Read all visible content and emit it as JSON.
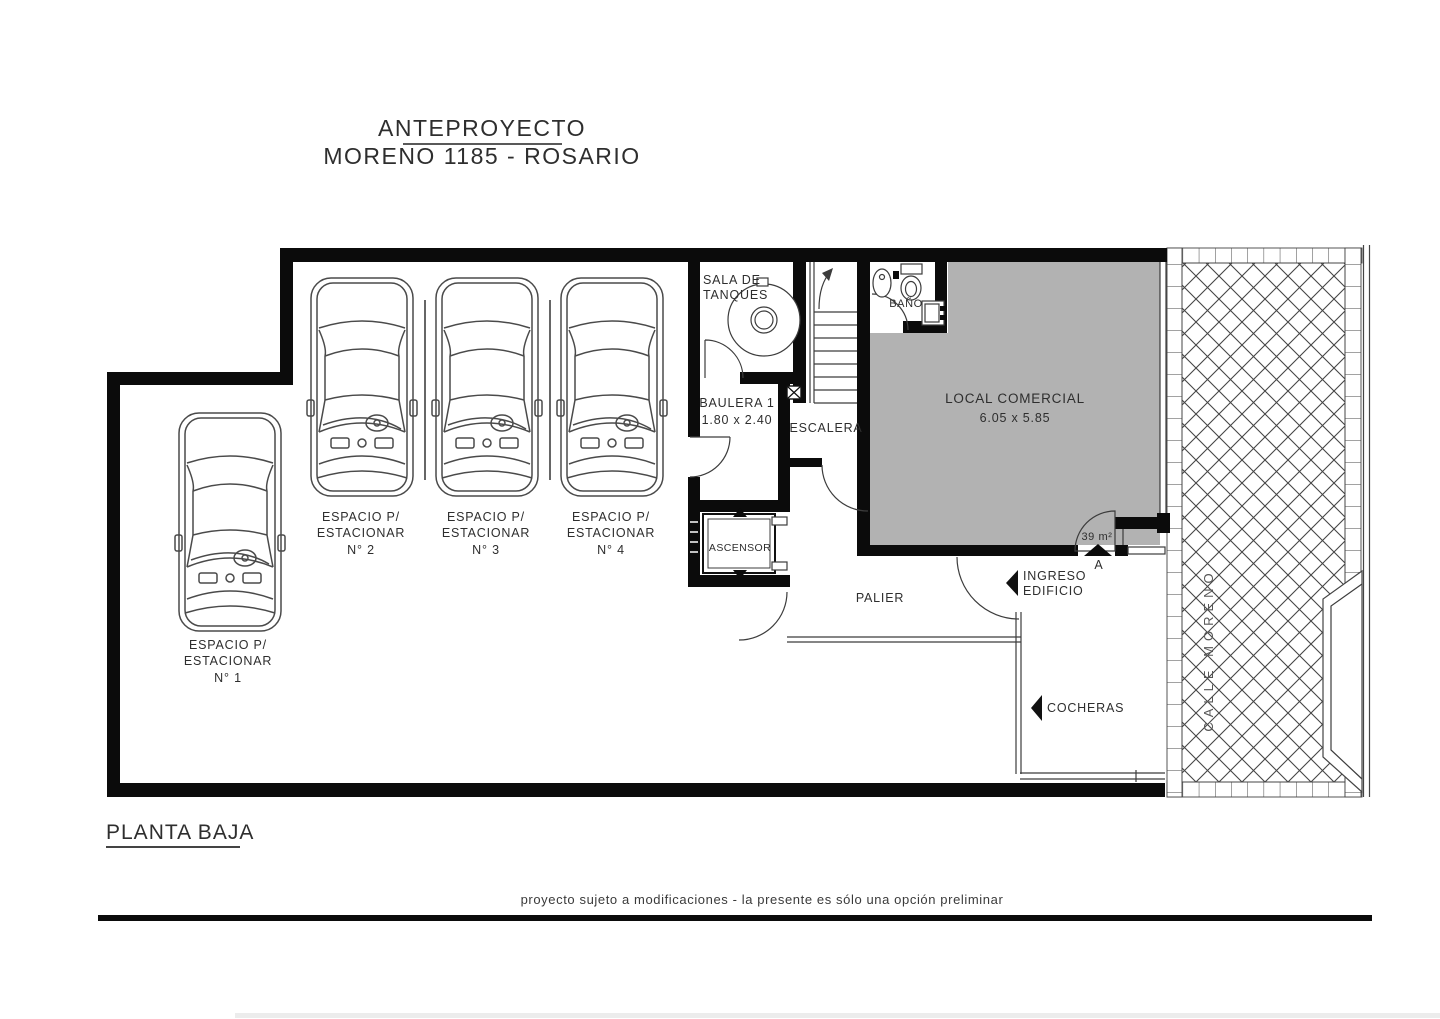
{
  "header": {
    "project_type": "ANTEPROYECTO",
    "project_address": "MORENO 1185 - ROSARIO"
  },
  "floor_label": "PLANTA BAJA",
  "footer_note": "proyecto sujeto a modificaciones - la presente es sólo una opción preliminar",
  "rooms": {
    "sala_de_tanques": {
      "line1": "SALA DE",
      "line2": "TANQUES"
    },
    "baulera": {
      "name": "BAULERA 1",
      "dims": "1.80 x 2.40"
    },
    "escalera": {
      "name": "ESCALERA"
    },
    "ascensor": {
      "name": "ASCENSOR"
    },
    "bano": {
      "name": "BAÑO"
    },
    "local": {
      "name": "LOCAL COMERCIAL",
      "dims": "6.05 x 5.85",
      "area": "39 m²",
      "door_tag": "A"
    },
    "palier": {
      "name": "PALIER"
    },
    "ingreso": {
      "line1": "INGRESO",
      "line2": "EDIFICIO"
    },
    "cocheras": {
      "name": "COCHERAS"
    },
    "street": {
      "name": "CALLE MORENO"
    }
  },
  "parking_spaces": [
    {
      "line1": "ESPACIO P/",
      "line2": "ESTACIONAR",
      "number": "N° 1"
    },
    {
      "line1": "ESPACIO P/",
      "line2": "ESTACIONAR",
      "number": "N° 2"
    },
    {
      "line1": "ESPACIO P/",
      "line2": "ESTACIONAR",
      "number": "N° 3"
    },
    {
      "line1": "ESPACIO P/",
      "line2": "ESTACIONAR",
      "number": "N° 4"
    }
  ],
  "colors": {
    "wall": "#0b0b0b",
    "local_fill": "#b2b2b2",
    "line": "#3c3c3c",
    "text": "#2e2e2e"
  }
}
